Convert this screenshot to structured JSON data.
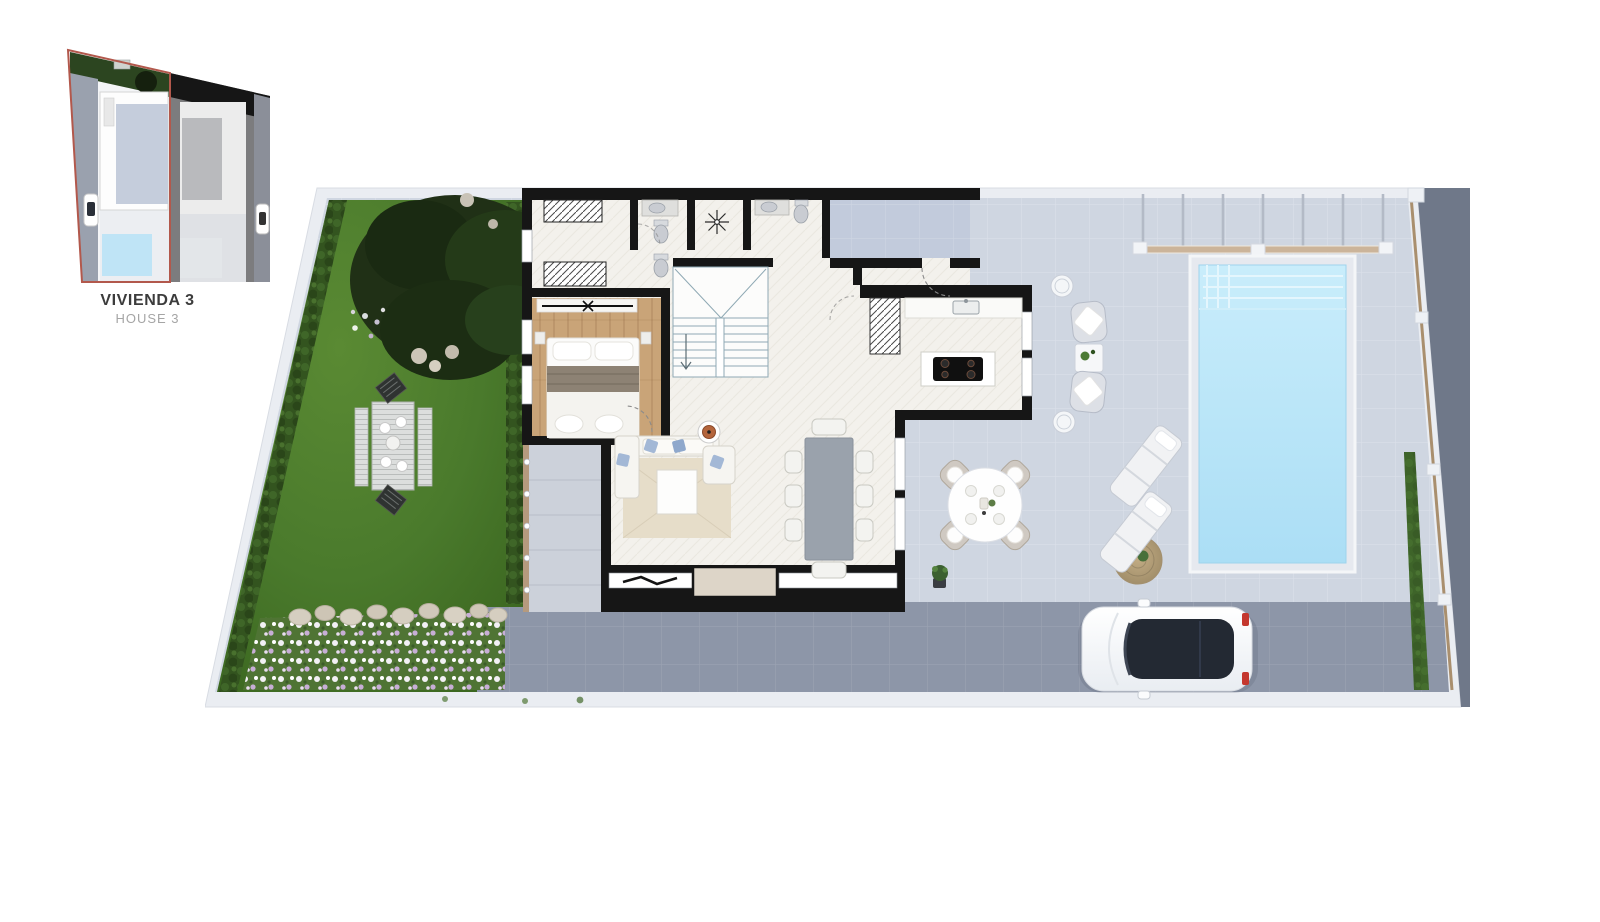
{
  "inset": {
    "title": "VIVIENDA 3",
    "subtitle": "HOUSE 3"
  },
  "features": [
    "site-plan-thumbnail",
    "garden",
    "tree",
    "picnic-table",
    "flower-bed",
    "hedge",
    "bedroom",
    "wardrobe",
    "bathroom-1",
    "wc",
    "bathroom-2",
    "hall-light",
    "stairs",
    "kitchen",
    "kitchen-island-cooktop",
    "pantry-shelves",
    "living-room",
    "sofa",
    "rug",
    "coffee-table",
    "tv",
    "dining-table-8-chairs",
    "entry-porch",
    "side-deck",
    "terrace",
    "wicker-lounge-set",
    "outdoor-dining-table-4-chairs",
    "sun-loungers",
    "jute-rug",
    "potted-plant",
    "pool",
    "pool-steps",
    "pergola-slats",
    "boundary-fence",
    "driveway",
    "car",
    "sidewalk"
  ],
  "counts": {
    "dining_chairs": 8,
    "outdoor_dining_chairs": 4,
    "sun_loungers": 2,
    "wicker_chairs": 2
  },
  "colors": {
    "page_bg": "#ffffff",
    "curb": "#eaedf2",
    "curb_edge": "#d8dce3",
    "outside": "#6f7889",
    "terrace": "#cfd6e1",
    "porch": "#c2cbdc",
    "deck": "#ccd1da",
    "garden_light": "#548230",
    "garden_dark": "#3d6a22",
    "hedge": "#2e4c1d",
    "tree": "#1f3015",
    "flower_green": "#4f7434",
    "wall": "#161616",
    "floor": "#f3f1ec",
    "wood": "#c9a478",
    "stairs_line": "#8fa9b4",
    "bath_fixture": "#c9ccd2",
    "rug": "#e6ddc9",
    "sofa": "#f6f5f1",
    "pillow_blue": "#a3b8d6",
    "table_accent": "#b4653c",
    "dining_table": "#9aa2ac",
    "chair": "#f3f3f0",
    "outdoor_chair": "#c9c3ba",
    "pool_water_top": "#c9edfb",
    "pool_water": "#abdef5",
    "pool_coping": "#e6e9ef",
    "pergola_wood": "#cbb49a",
    "fence_wood": "#a98f6e",
    "driveway": "#8d96a8",
    "car_body": "#f7f8fa",
    "car_glass": "#232933",
    "taillight": "#c4372e",
    "jute": "#b3a07c",
    "label_title": "#3c3c3c",
    "label_subtitle": "#a5a5a5",
    "inset_outline": "#b2584c"
  }
}
